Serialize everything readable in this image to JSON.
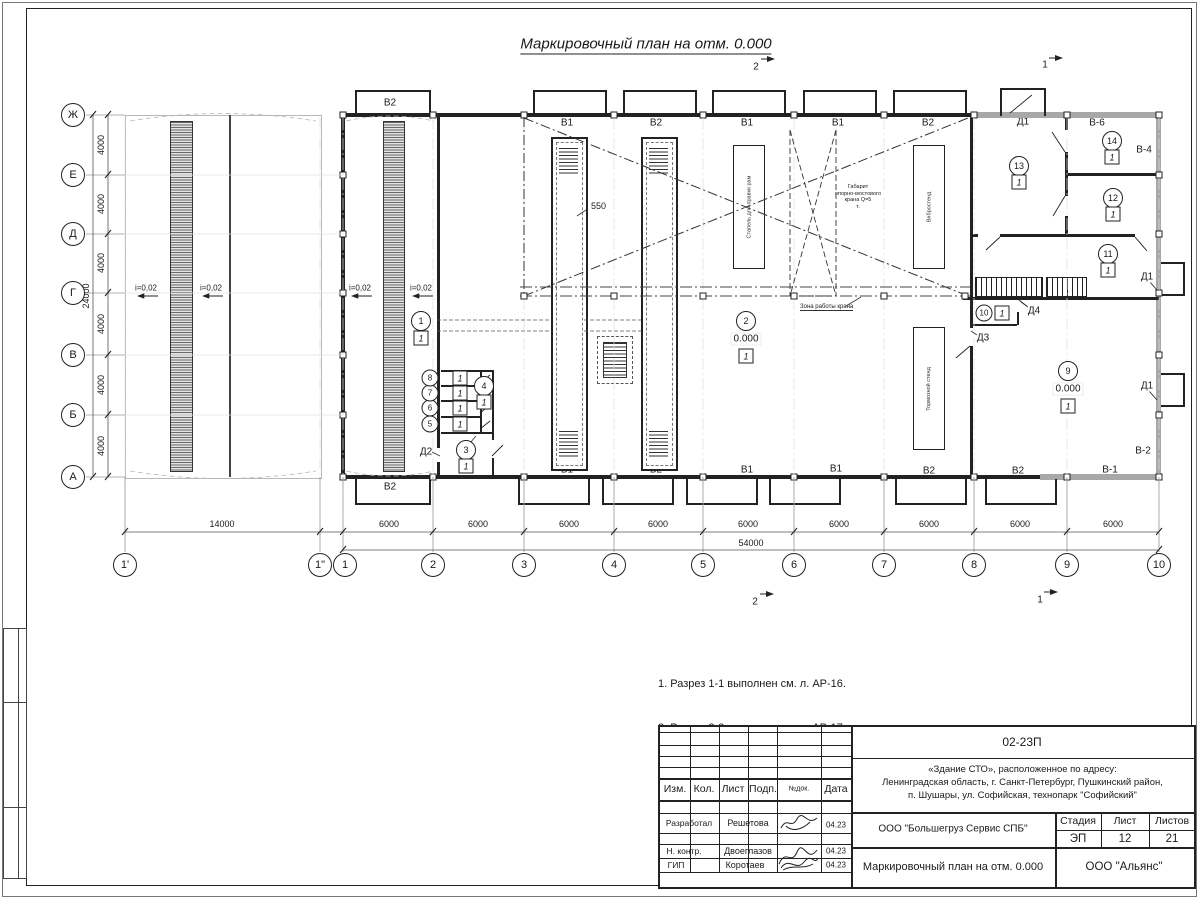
{
  "sheet": {
    "title": "Маркировочный план на отм. 0.000"
  },
  "axes": {
    "letters": [
      "Ж",
      "Е",
      "Д",
      "Г",
      "В",
      "Б",
      "А"
    ],
    "numbers": [
      "1'",
      "1\"",
      "1",
      "2",
      "3",
      "4",
      "5",
      "6",
      "7",
      "8",
      "9",
      "10"
    ],
    "dim_step_v": "4000",
    "dim_total_v": "24000",
    "dim_first_bay": "14000",
    "dim_step_h": "6000",
    "dim_total_h": "54000"
  },
  "slope_label": "i=0,02",
  "section_marks": {
    "one": "1",
    "two": "2"
  },
  "windows_top": [
    "В2",
    "В1",
    "В2",
    "В1",
    "В1",
    "В2"
  ],
  "windows_bottom": [
    "В2",
    "В1",
    "В2",
    "В1",
    "В1",
    "В2",
    "В2",
    "В-1"
  ],
  "window_labels": {
    "v6": "В-6",
    "v4": "В-4",
    "v2": "В-2"
  },
  "doors": {
    "d1": "Д1",
    "d2": "Д2",
    "d3": "Д3",
    "d4": "Д4"
  },
  "rooms": [
    {
      "num": "1",
      "floor": "1"
    },
    {
      "num": "2",
      "floor": "1",
      "elev": "0.000"
    },
    {
      "num": "3",
      "floor": "1"
    },
    {
      "num": "4",
      "floor": "1"
    },
    {
      "num": "5",
      "floor": "1"
    },
    {
      "num": "6",
      "floor": "1"
    },
    {
      "num": "7",
      "floor": "1"
    },
    {
      "num": "8",
      "floor": "1"
    },
    {
      "num": "9",
      "floor": "1",
      "elev": "0.000"
    },
    {
      "num": "10",
      "floor": "1"
    },
    {
      "num": "11",
      "floor": "1"
    },
    {
      "num": "12",
      "floor": "1"
    },
    {
      "num": "13",
      "floor": "1"
    },
    {
      "num": "14",
      "floor": "1"
    }
  ],
  "pit": {
    "elevation": "-1.250",
    "width": "550"
  },
  "equipment": {
    "stapel": "Стапель для правки рам",
    "vibro": "Вибростенд",
    "tormoz": "Тормозной стенд"
  },
  "crane": {
    "clearance_lines": [
      "Габарит",
      "опорно-мостового",
      "крана Q=5",
      "т."
    ],
    "zone": "Зона работы крана"
  },
  "notes": [
    "1. Разрез 1-1 выполнен см. л. АР-16.",
    "2. Разрез 2-2 выполнен см. л. АР-17.",
    "3. Спецификация заполнения оконных и дверных",
    "    проемов выполнена см. л. АР-21.",
    "4. Экспликация полов выполнена см. л. АР-21."
  ],
  "titleblock": {
    "doc_number": "02-23П",
    "object_lines": [
      "«Здание СТО», расположенное по адресу:",
      "Ленинградская область, г. Санкт-Петербург, Пушкинский район,",
      "п. Шушары, ул. Софийская, технопарк \"Софийский\""
    ],
    "cols": {
      "izm": "Изм.",
      "kol": "Кол.",
      "list": "Лист",
      "ndok": "№док.",
      "podp": "Подп.",
      "data": "Дата"
    },
    "rows": [
      {
        "role": "Разработал",
        "name": "Решетова",
        "date": "04.23"
      },
      {
        "role": "Н. контр.",
        "name": "Двоеглазов",
        "date": "04.23"
      },
      {
        "role": "ГИП",
        "name": "Коротаев",
        "date": "04.23"
      }
    ],
    "company": "ООО \"Большегруз Сервис СПБ\"",
    "stage_label": "Стадия",
    "sheet_label": "Лист",
    "sheets_label": "Листов",
    "stage": "ЭП",
    "sheet_num": "12",
    "sheets_total": "21",
    "drawing_title": "Маркировочный план на отм. 0.000",
    "firm": "ООО \"Альянс\""
  }
}
